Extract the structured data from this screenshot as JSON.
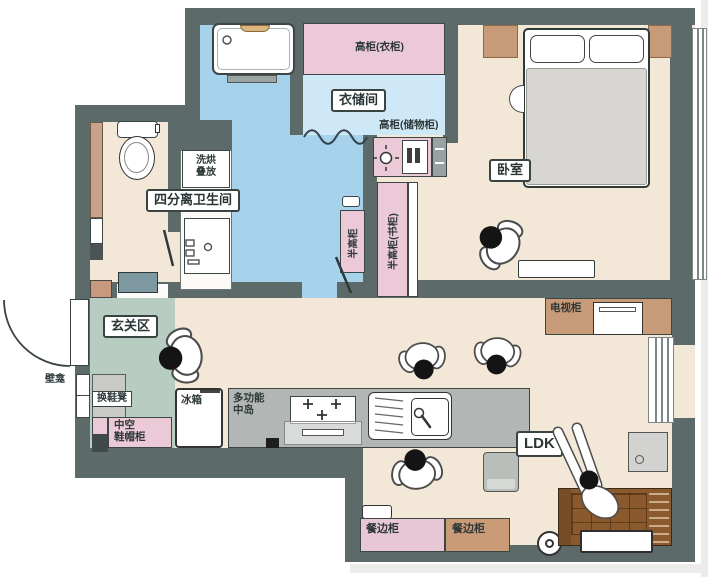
{
  "rooms": {
    "bedroom": "卧室",
    "closet": "衣储间",
    "bathroom": "四分离卫生间",
    "entry": "玄关区",
    "ldk": "LDK"
  },
  "cabinets": {
    "wardrobe_top": "高柜(衣柜)",
    "storage_top": "高柜(储物柜)",
    "half_tall_desk": "半高柜(书柜)",
    "half_tall": "半高柜",
    "laundry": "洗烘\n叠放",
    "tv": "电视柜",
    "shoe_stool": "换鞋凳",
    "niche": "壁龛",
    "shoe_cabinet": "中空\n鞋帽柜",
    "fridge": "冰箱",
    "island": "多功能\n中岛",
    "sideboard_left": "餐边柜",
    "sideboard_right": "餐边柜"
  },
  "colors": {
    "wall": "#5c6b69",
    "floor": "#f3e8d8",
    "wet_area": "#a6d2ec",
    "closet_floor": "#cfe8f7",
    "cabinet_pink": "#ecc9d7",
    "wood_tan": "#c89b78",
    "entry_green": "#b7cdc1",
    "island_gray": "#b2b7b5",
    "bed_gray": "#d7d6d3",
    "sofa_brown": "#8a5a2e",
    "teal_cabinet": "#7e98a2",
    "ink": "#2e3838"
  }
}
